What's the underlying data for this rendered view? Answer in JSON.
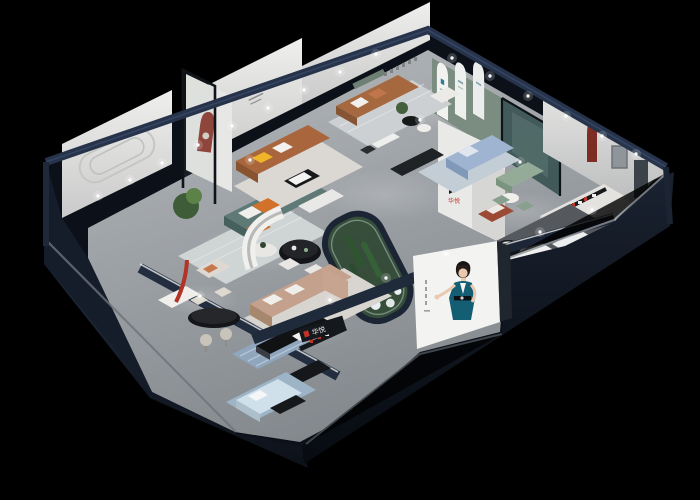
{
  "scene": {
    "description": "Isometric 3D cutaway render of a furniture showroom at night",
    "background": "#000000"
  },
  "brand": {
    "mark": "H",
    "interior_logo_text": "华悦",
    "front_sign_text": "华悦",
    "logo_red": "#c23527",
    "logo_black": "#16181b"
  },
  "palette": {
    "exterior_wall": "#121926",
    "wall_top_band": "#27344a",
    "interior_wall": "#e9e9e7",
    "floor": "#a6abaf",
    "accent_niche_red": "#8e3a30",
    "sofa_teal": "#5e7976",
    "sofa_brown": "#a9663c",
    "sofa_tan": "#c4a18c",
    "sofa_blue": "#9fb4d0",
    "green_arch_wall": "#7b8c80",
    "plant_green": "#3f5c38",
    "poster_dress_teal": "#145e74",
    "poster_background": "#f3f3f1"
  },
  "poster": {
    "subject": "woman in teal evening dress",
    "location": "front facade banner"
  }
}
